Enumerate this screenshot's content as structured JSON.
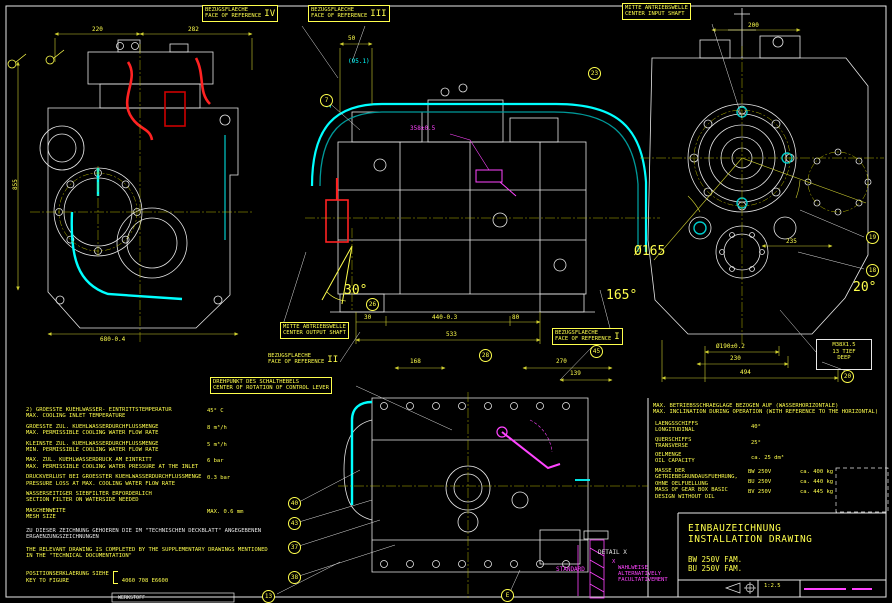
{
  "sheet": {
    "title_de": "EINBAUZEICHNUNG",
    "title_en": "INSTALLATION DRAWING",
    "model_1": "BW 250V FAM.",
    "model_2": "BU 250V FAM.",
    "scale": "1:2.5",
    "material_label": "WERKSTOFF",
    "colors": {
      "line_yellow": "#ffff4d",
      "line_white": "#e8e8e8",
      "pipe_cyan": "#00ffff",
      "pipe_red": "#ff2222",
      "accent_magenta": "#ff44ff"
    }
  },
  "ref_labels": {
    "ref_iv_de": "BEZUGSFLAECHE",
    "ref_iv_en": "FACE OF REFERENCE",
    "ref_iv_num": "IV",
    "ref_iii_de": "BEZUGSFLAECHE",
    "ref_iii_en": "FACE OF REFERENCE",
    "ref_iii_num": "III",
    "ref_i_de": "BEZUGSFLAECHE",
    "ref_i_en": "FACE OF REFERENCE",
    "ref_i_num": "I",
    "ref_ii_de": "BEZUGSFLAECHE",
    "ref_ii_en": "FACE OF REFERENCE",
    "ref_ii_num": "II",
    "input_de": "MITTE ANTRIEBSWELLE",
    "input_en": "CENTER INPUT SHAFT",
    "output_de": "MITTE ABTRIEBSWELLE",
    "output_en": "CENTER OUTPUT SHAFT",
    "pivot_de": "DREHPUNKT DES SCHALTHEBELS",
    "pivot_en": "CENTER OF ROTATION OF CONTROL LEVER"
  },
  "thread_note": {
    "size": "M38X1.5",
    "depth_de": "13 TIEF",
    "depth_en": "DEEP"
  },
  "dims": {
    "t220": "220",
    "t282": "282",
    "v855": "855",
    "b680": "680-0.4",
    "m50": "50",
    "c951": "(95.1)",
    "c20": "20",
    "mag358": "358±0.5",
    "m30": "30",
    "m440": "440-0.3",
    "m80": "80",
    "m533": "533",
    "a30": "30°",
    "f168": "168",
    "f270": "270",
    "f139": "139",
    "r200": "200",
    "r235": "235",
    "rd165": "Ø165",
    "a165": "165°",
    "a20": "20°",
    "rd190": "Ø190±0.2",
    "r230": "230",
    "r494": "494"
  },
  "balloons": {
    "b7": "7",
    "b23": "23",
    "b26": "26",
    "b28": "28",
    "b45": "45",
    "b19": "19",
    "b18": "18",
    "b20": "20",
    "b40": "40",
    "b43": "43",
    "b37": "37",
    "b38": "38",
    "b13": "13",
    "bE": "E"
  },
  "detail_x": {
    "title": "DETAIL X",
    "standard": "STANDARD",
    "alt_x": "X",
    "alt_de": "WAHLWEISE",
    "alt_en": "ALTERNATIVELY",
    "alt_fr": "FACULTATIVEMENT"
  },
  "notes_left": {
    "rows": [
      {
        "de": "2) GROESSTE KUEHLWASSER- EINTRITTSTEMPERATUR",
        "en": "MAX. COOLING INLET TEMPERATURE",
        "value": "45° C"
      },
      {
        "de": "GROESSTE ZUL. KUEHLWASSERDURCHFLUSSMENGE",
        "en": "MAX. PERMISSIBLE COOLING WATER FLOW RATE",
        "value": "8 m³/h"
      },
      {
        "de": "KLEINSTE ZUL. KUEHLWASSERDURCHFLUSSMENGE",
        "en": "MIN. PERMISSIBLE COOLING WATER FLOW RATE",
        "value": "5 m³/h"
      },
      {
        "de": "MAX. ZUL. KUEHLWASSERDRUCK AM EINTRITT",
        "en": "MAX. PERMISSIBLE COOLING WATER PRESSURE AT THE INLET",
        "value": "6 bar"
      },
      {
        "de": "DRUCKVERLUST BEI GROESSTER KUEHLWASSERDURCHFLUSSMENGE",
        "en": "PRESSURE LOSS AT MAX. COOLING WATER FLOW RATE",
        "value": "0.3 bar"
      },
      {
        "de": "WASSERSEITIGER SIEBFILTER ERFORDERLICH",
        "en": "SECTION FILTER ON WATERSIDE NEEDED",
        "value": ""
      },
      {
        "de": "MASCHENWEITE",
        "en": "MESH SIZE",
        "value": "MAX. 0.6 mm"
      }
    ],
    "supplement_de": "ZU DIESER ZEICHNUNG GEHOEREN DIE IM \"TECHNISCHEN DECKBLATT\" ANGEGEBENEN ERGAENZUNGSZEICHNUNGEN",
    "supplement_en": "THE RELEVANT DRAWING IS COMPLETED BY THE SUPPLEMENTARY DRAWINGS MENTIONED IN THE \"TECHNICAL DOCUMENTATION\"",
    "key_de": "POSITIONSERKLAERUNG SIEHE",
    "key_en": "KEY TO FIGURE",
    "key_value": "4060 708 E6600"
  },
  "notes_right": {
    "header_de": "MAX. BETRIEBSSCHRAEGLAGE BEZOGEN AUF (WASSERHORIZONTALE)",
    "header_en": "MAX. INCLINATION DURING OPERATION (WITH REFERENCE TO THE HORIZONTAL)",
    "rows": [
      {
        "de": "LAENGSSCHIFFS",
        "en": "LONGITUDINAL",
        "value": "40°"
      },
      {
        "de": "QUERSCHIFFS",
        "en": "TRANSVERSE",
        "value": "25°"
      },
      {
        "de": "OELMENGE",
        "en": "OIL CAPACITY",
        "value": "ca. 25 dm³"
      }
    ],
    "mass_de": "MASSE DER GETRIEBEGRUNDAUSFUEHRUNG, OHNE OELFUELLUNG",
    "mass_en": "MASS OF GEAR BOX BASIC DESIGN WITHOUT OIL",
    "mass_rows": [
      {
        "variant": "BW 250V",
        "value": "ca. 400 kg"
      },
      {
        "variant": "BU 250V",
        "value": "ca. 440 kg"
      },
      {
        "variant": "BV 250V",
        "value": "ca. 445 kg"
      }
    ]
  }
}
